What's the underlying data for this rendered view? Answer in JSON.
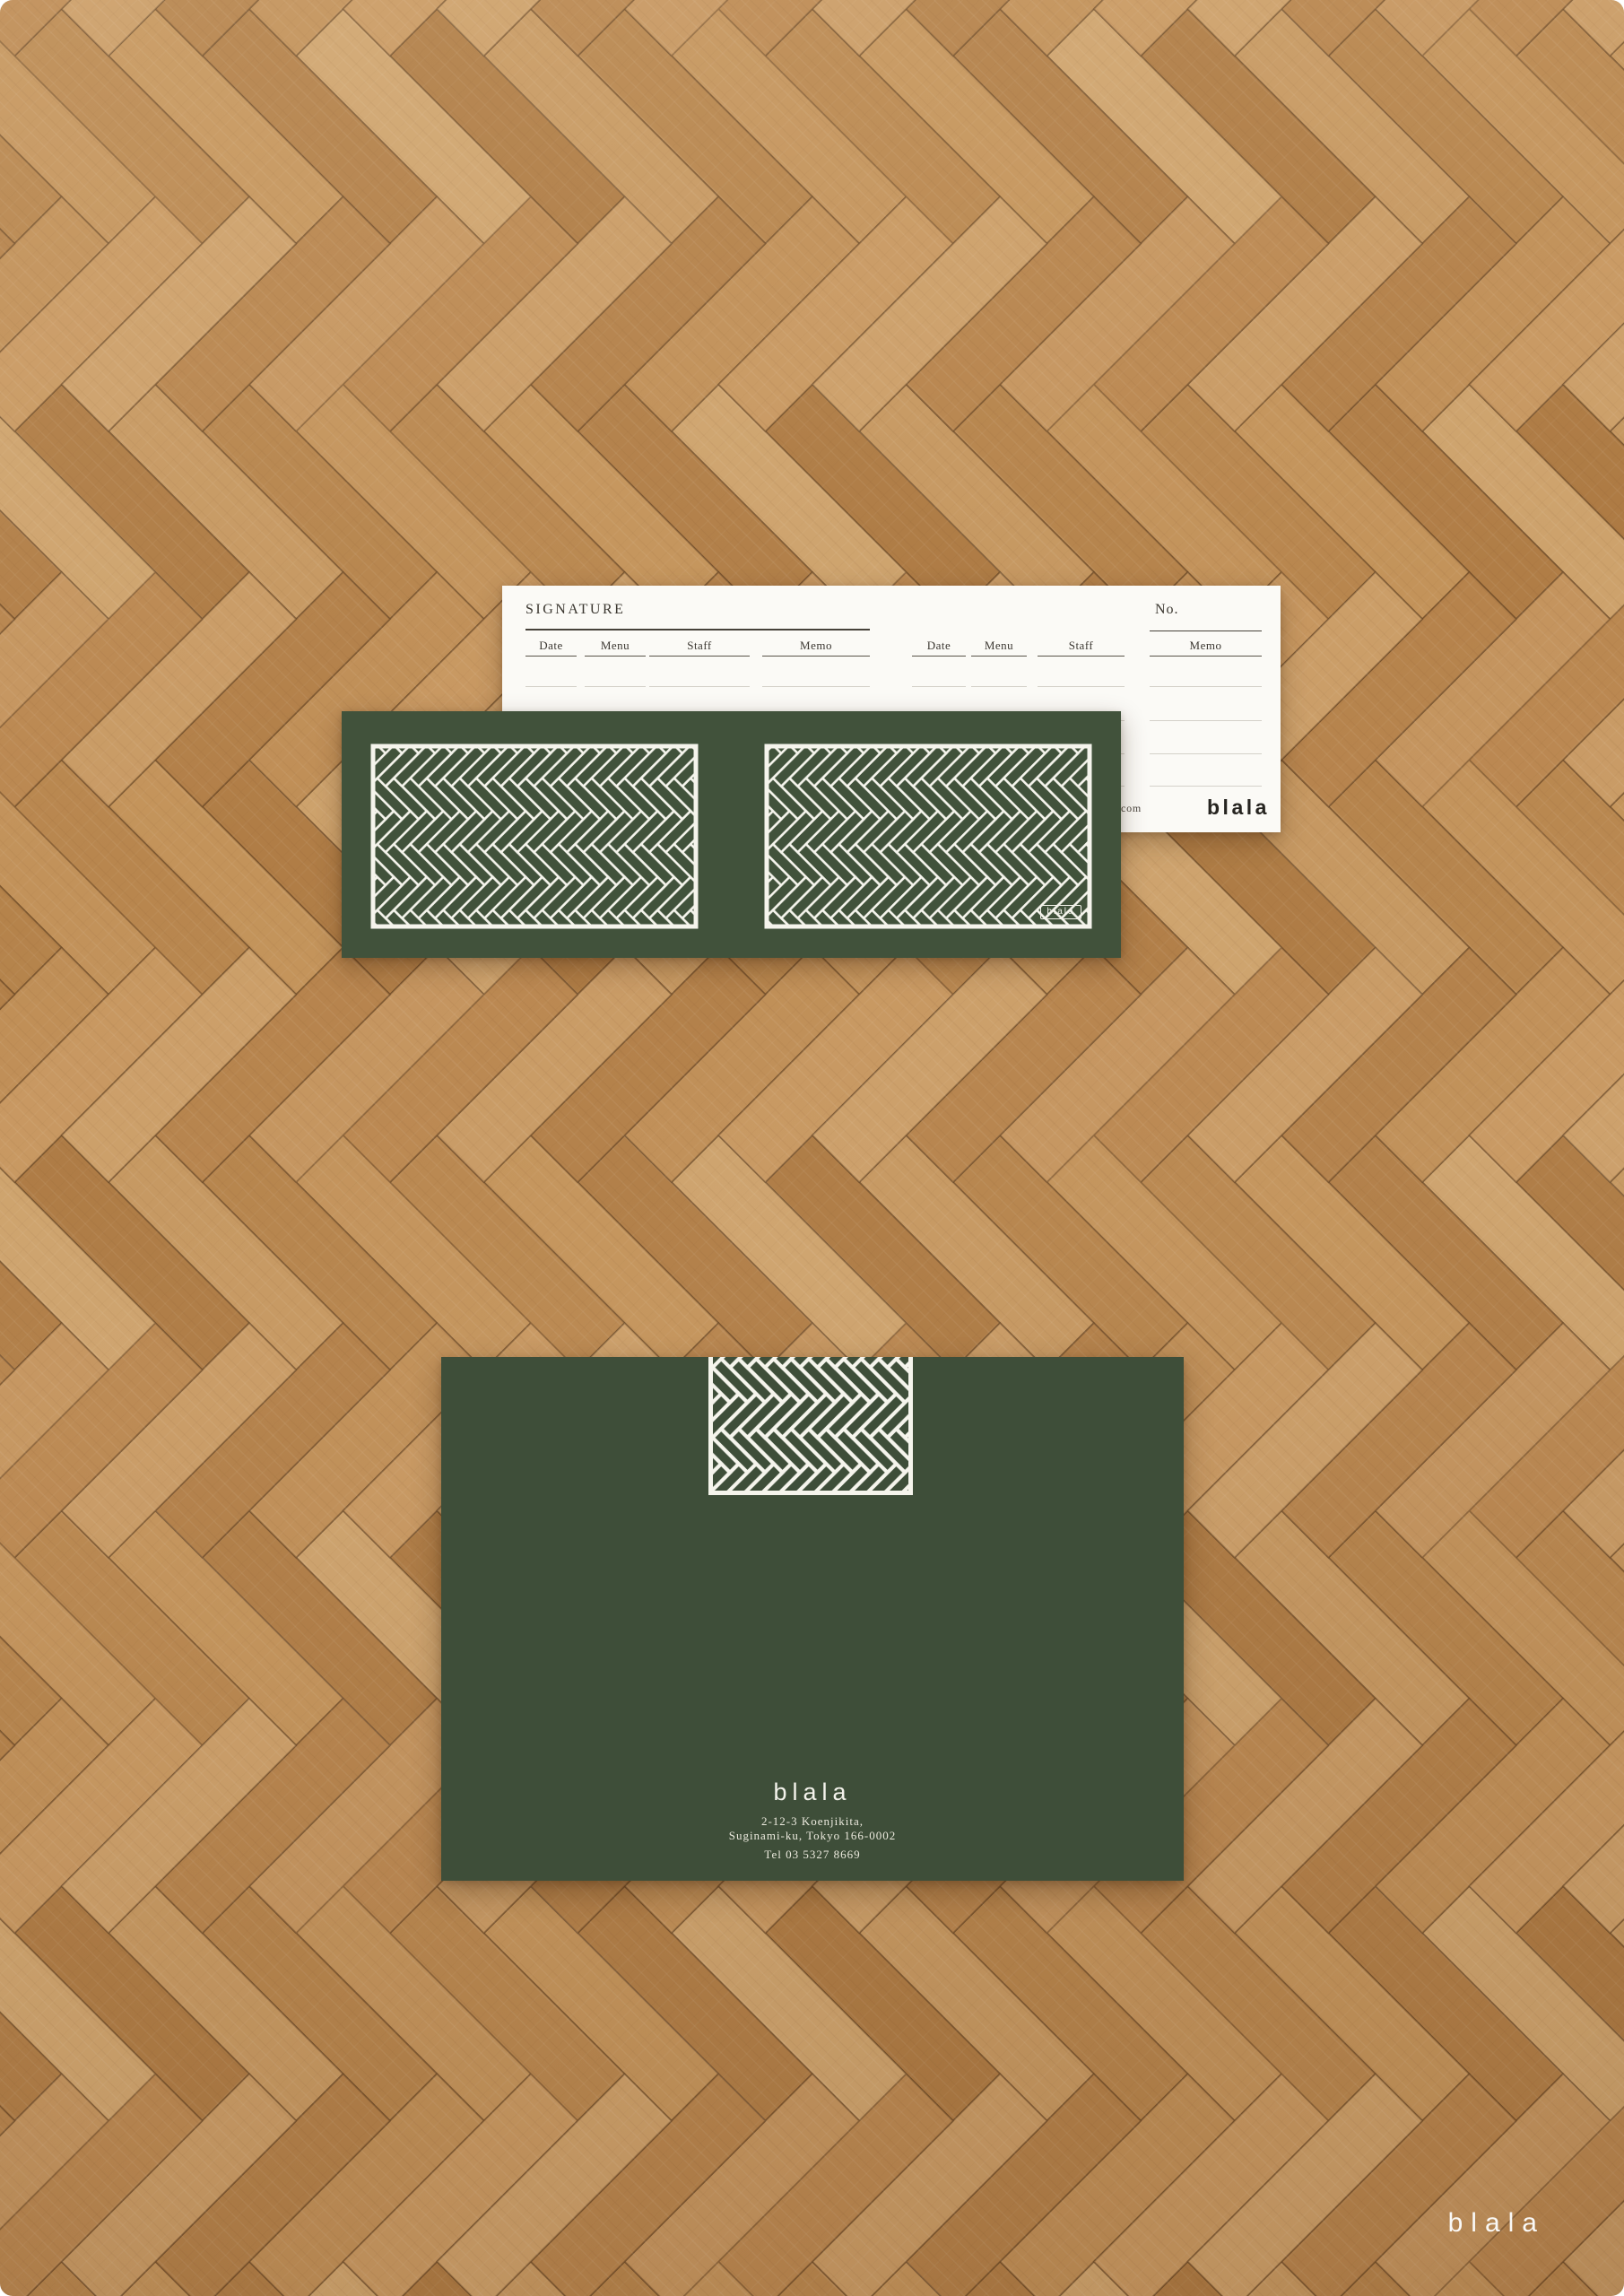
{
  "colors": {
    "brand_green": "#41523b",
    "envelope_green": "#3e4e39",
    "pattern_white": "#f5f4ec",
    "card_white": "#fbfaf6",
    "ink": "#3a362f",
    "wood_mid": "#bc8a52"
  },
  "signature_card": {
    "title": "SIGNATURE",
    "no_label": "No.",
    "columns": [
      "Date",
      "Menu",
      "Staff",
      "Memo"
    ],
    "rows_per_column": 4,
    "url_fragment": "com",
    "logo": "blala"
  },
  "voucher_card": {
    "badge": "blala"
  },
  "envelope": {
    "logo": "blala",
    "address_line1": "2-12-3 Koenjikita,",
    "address_line2": "Suginami-ku, Tokyo 166-0002",
    "phone": "Tel 03 5327 8669"
  },
  "watermark": {
    "text": "blala"
  }
}
